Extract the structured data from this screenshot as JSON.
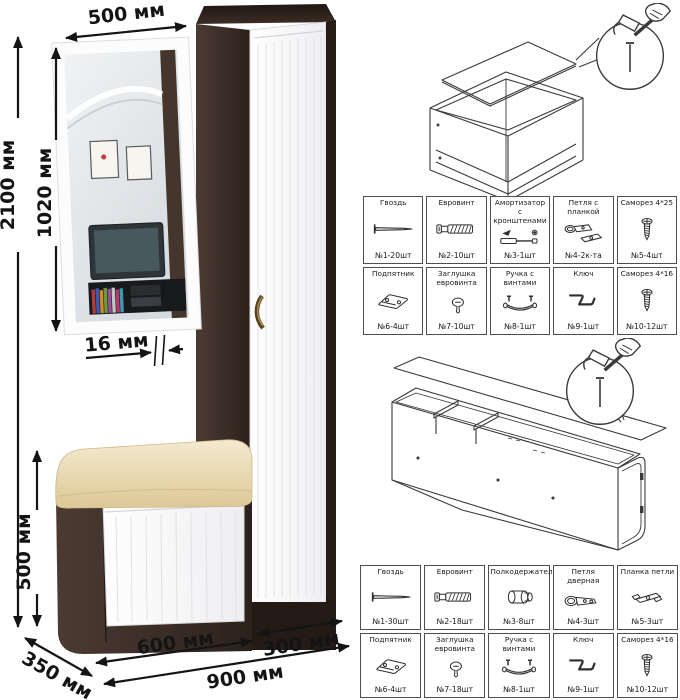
{
  "dimensions": {
    "overall_height": "2100 мм",
    "mirror_height": "1020 мм",
    "mirror_width": "500 мм",
    "panel_thickness": "16 мм",
    "bench_height": "500 мм",
    "depth": "350 мм",
    "bench_width": "600 мм",
    "overall_width": "900 мм",
    "cabinet_width": "300 мм"
  },
  "hardware_top": {
    "cells": [
      {
        "name": "Гвоздь",
        "qty": "№1-20шт"
      },
      {
        "name": "Евровинт",
        "qty": "№2-10шт"
      },
      {
        "name": "Амортизатор с кронштенами",
        "qty": "№3-1шт"
      },
      {
        "name": "Петля с планкой",
        "qty": "№4-2к-та"
      },
      {
        "name": "Саморез 4*25",
        "qty": "№5-4шт"
      },
      {
        "name": "Подпятник",
        "qty": "№6-4шт"
      },
      {
        "name": "Заглушка евровинта",
        "qty": "№7-10шт"
      },
      {
        "name": "Ручка с винтами",
        "qty": "№8-1шт"
      },
      {
        "name": "Ключ",
        "qty": "№9-1шт"
      },
      {
        "name": "Саморез 4*16",
        "qty": "№10-12шт"
      }
    ]
  },
  "hardware_bottom": {
    "cells": [
      {
        "name": "Гвоздь",
        "qty": "№1-30шт"
      },
      {
        "name": "Евровинт",
        "qty": "№2-18шт"
      },
      {
        "name": "Полкодержатель",
        "qty": "№3-8шт"
      },
      {
        "name": "Петля дверная",
        "qty": "№4-3шт"
      },
      {
        "name": "Планка петли",
        "qty": "№5-3шт"
      },
      {
        "name": "Подпятник",
        "qty": "№6-4шт"
      },
      {
        "name": "Заглушка евровинта",
        "qty": "№7-18шт"
      },
      {
        "name": "Ручка с винтами",
        "qty": "№8-1шт"
      },
      {
        "name": "Ключ",
        "qty": "№9-1шт"
      },
      {
        "name": "Саморез 4*16",
        "qty": "№10-12шт"
      }
    ]
  },
  "colors": {
    "wenge_dark": "#32261f",
    "wenge_light": "#4b3b33",
    "door_white": "#fbfbfd",
    "cushion_cream": "#ead9ae",
    "line_dark": "#3a3a3a"
  }
}
